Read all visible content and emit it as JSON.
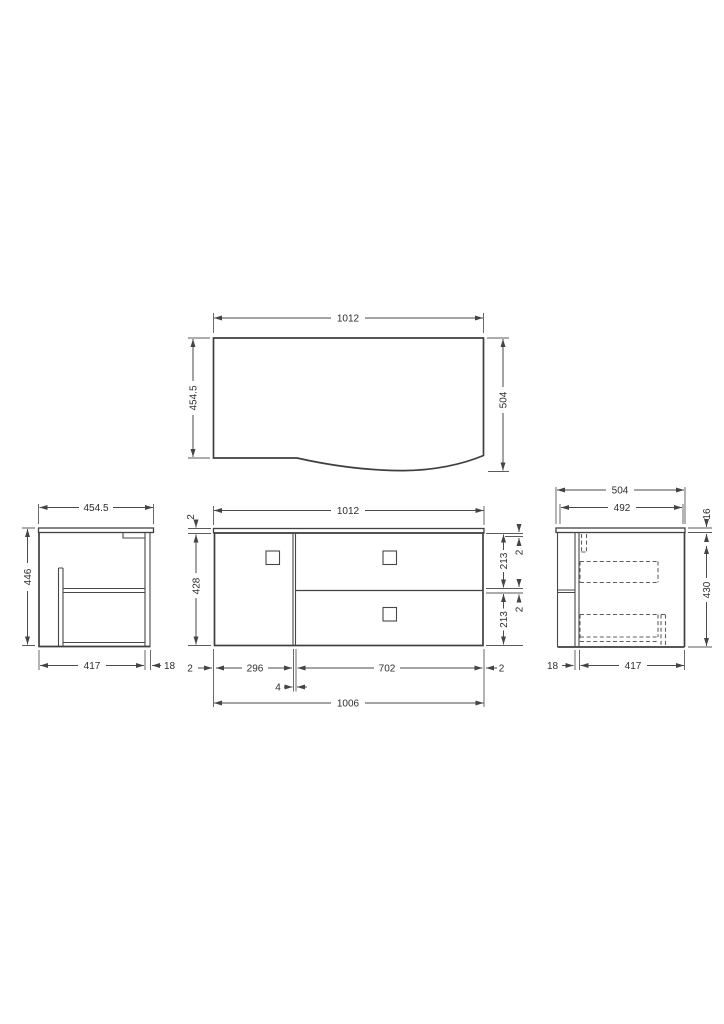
{
  "drawing": {
    "type": "technical-dimension-drawing",
    "subject": "wall-hung vanity unit with curved front, one door and two drawers",
    "units": "mm",
    "colors": {
      "line": "#474747",
      "text": "#2e2e2e",
      "background": "#ffffff"
    },
    "views": [
      "plan",
      "front",
      "left-side",
      "right-side"
    ]
  },
  "dims": {
    "plan_width": "1012",
    "plan_depth_left": "454.5",
    "plan_depth_right": "504",
    "front_width": "1012",
    "front_top_gap": "2",
    "front_height": "428",
    "front_gap_a": "2",
    "front_drawer_a": "213",
    "front_gap_b": "2",
    "front_drawer_b": "213",
    "front_edge_l": "2",
    "front_door_w": "296",
    "front_gap_c": "4",
    "front_drawers_w": "702",
    "front_edge_r": "2",
    "front_body_w": "1006",
    "left_depth": "454.5",
    "left_height": "446",
    "left_body_depth": "417",
    "left_back_panel": "18",
    "right_counter": "504",
    "right_inner": "492",
    "right_counter_th": "16",
    "right_body_h": "430",
    "right_front_off": "18",
    "right_body_depth": "417"
  }
}
